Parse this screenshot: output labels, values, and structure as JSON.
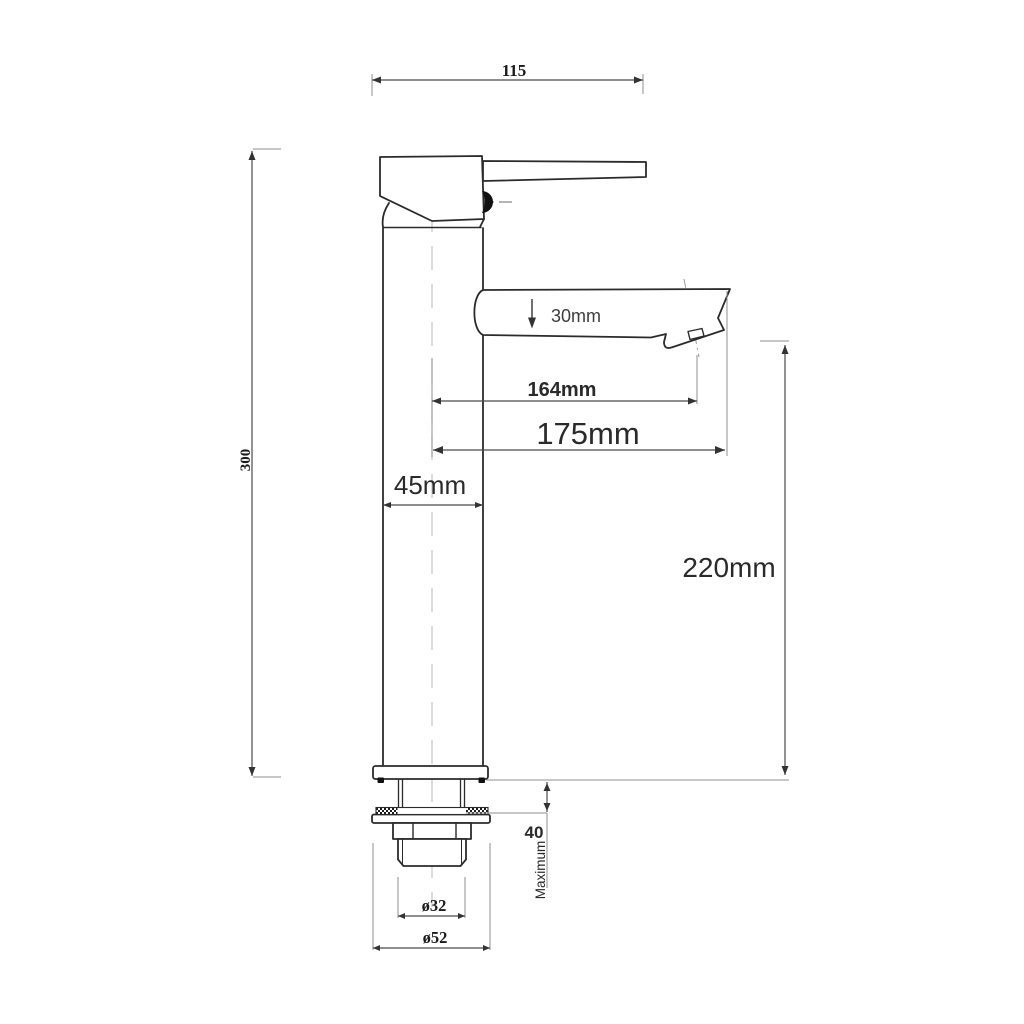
{
  "colors": {
    "outline": "#2b2b2b",
    "dimension": "#4a4a4a",
    "arrow": "#333333",
    "extension": "#8f8f8f",
    "centerline": "#c5c5c5",
    "centerline_dark": "#9a9a9a",
    "background": "#ffffff"
  },
  "dimensions": {
    "width_top": "115",
    "height_overall": "300",
    "spout_pipe": "30mm",
    "reach_aerator": "164mm",
    "reach_spout": "175mm",
    "body_diameter": "45mm",
    "spout_height": "220mm",
    "deck_max": "40",
    "deck_max_note": "Maximum",
    "thread_diameter": "ø32",
    "base_diameter": "ø52"
  }
}
